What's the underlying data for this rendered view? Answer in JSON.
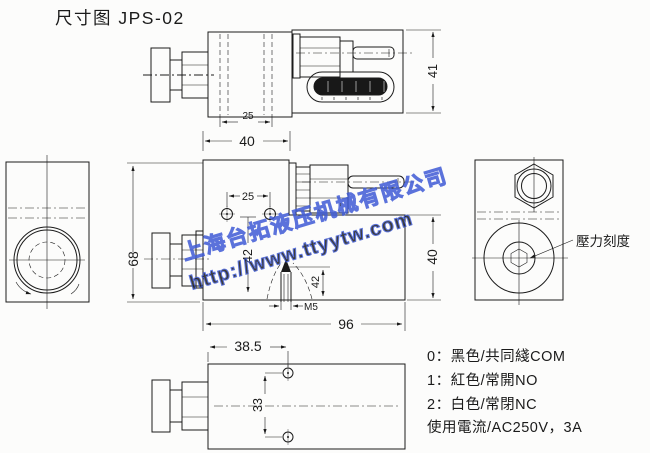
{
  "title": "尺寸图 JPS-02",
  "colors": {
    "line": "#1b1b1b",
    "watermark_blue": "#3f5bd6",
    "watermark_fill": "rgba(90,120,235,0.10)",
    "background": "#fcfcfb",
    "slot_fill": "#181818"
  },
  "watermark": {
    "company": "上海台拓液压机械有限公司",
    "url": "http://www.ttyytw.com"
  },
  "views": {
    "top": {
      "dim_slot": "25",
      "dim_body": "40",
      "dim_height": "41"
    },
    "main": {
      "dim_height": "68",
      "dim_hole_spacing": "25",
      "dim_hole_to_base": "42",
      "dim_screw": "42",
      "dim_thread": "M5",
      "dim_housing_height": "40",
      "dim_width": "96"
    },
    "rear": {
      "pressure_scale_label": "壓力刻度"
    },
    "bottom": {
      "dim_offset": "38.5",
      "dim_hole_spacing": "33"
    }
  },
  "legend": {
    "line1": "0：黑色/共同綫COM",
    "line2": "1：紅色/常開NO",
    "line3": "2：白色/常閉NC",
    "line4": "使用電流/AC250V，3A"
  }
}
